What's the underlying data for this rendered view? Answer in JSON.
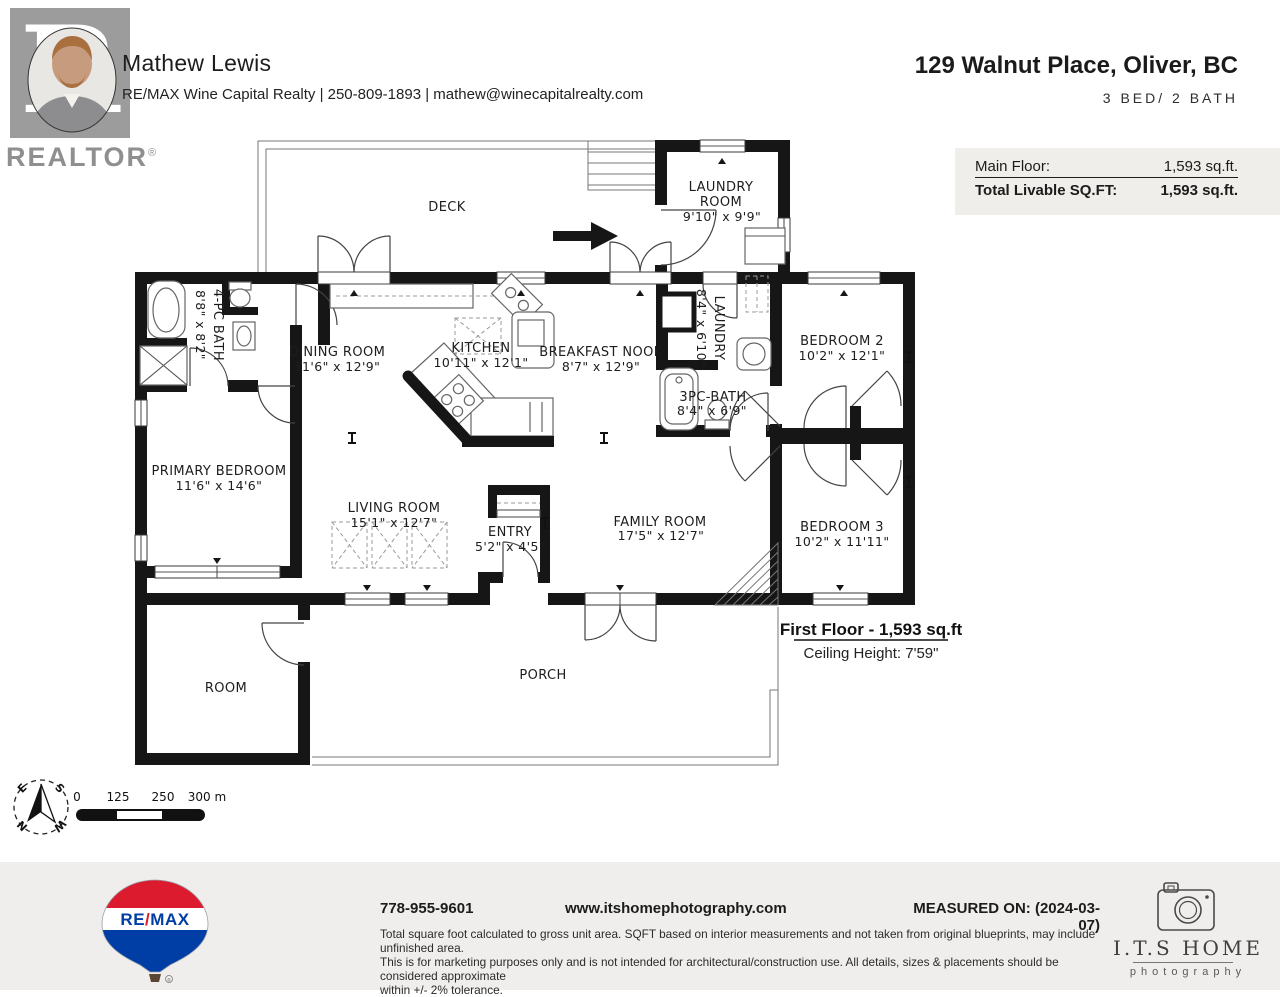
{
  "header": {
    "agent_name": "Mathew Lewis",
    "agent_line": "RE/MAX Wine Capital Realty | 250-809-1893 | mathew@winecapitalrealty.com",
    "realtor_word": "REALTOR",
    "reg": "®",
    "address": "129 Walnut Place, Oliver, BC",
    "bed_bath": "3 BED/ 2 BATH"
  },
  "sqft_box": {
    "rows": [
      {
        "label": "Main Floor:",
        "value": "1,593 sq.ft."
      },
      {
        "label": "Total Livable SQ.FT:",
        "value": "1,593 sq.ft."
      }
    ]
  },
  "plan": {
    "rooms": {
      "deck": {
        "name": "DECK"
      },
      "laundry_room": {
        "l1": "LAUNDRY",
        "l2": "ROOM",
        "dims": "9'10\" x 9'9\""
      },
      "bath4": {
        "name": "4-PC BATH",
        "dims": "8'8\" x 8'2\""
      },
      "dining": {
        "name": "DINING ROOM",
        "dims": "11'6\" x 12'9\""
      },
      "kitchen": {
        "name": "KITCHEN",
        "dims": "10'11\" x 12'1\""
      },
      "nook": {
        "name": "BREAKFAST NOOK",
        "dims": "8'7\" x 12'9\""
      },
      "laundry2": {
        "name": "LAUNDRY",
        "dims": "8'4\" x 6'10\""
      },
      "bed2": {
        "name": "BEDROOM 2",
        "dims": "10'2\" x 12'1\""
      },
      "bath3": {
        "name": "3PC-BATH",
        "dims": "8'4\" x 6'9\""
      },
      "primary": {
        "name": "PRIMARY BEDROOM",
        "dims": "11'6\" x 14'6\""
      },
      "living": {
        "name": "LIVING ROOM",
        "dims": "15'1\" x 12'7\""
      },
      "entry": {
        "name": "ENTRY",
        "dims": "5'2\" x 4'5\""
      },
      "family": {
        "name": "FAMILY ROOM",
        "dims": "17'5\" x 12'7\""
      },
      "bed3": {
        "name": "BEDROOM 3",
        "dims": "10'2\" x 11'11\""
      },
      "room": {
        "name": "ROOM"
      },
      "porch": {
        "name": "PORCH"
      }
    },
    "floor_note": {
      "title": "First Floor - 1,593 sq.ft",
      "ceiling": "Ceiling Height: 7'59\""
    }
  },
  "compass": {
    "e": "E",
    "s": "S",
    "n": "N",
    "w": "W"
  },
  "scale_bar": {
    "t0": "0",
    "t1": "125",
    "t2": "250",
    "t3": "300 m"
  },
  "footer": {
    "phone": "778-955-9601",
    "website": "www.itshomephotography.com",
    "measured_on": "MEASURED ON: (2024-03-07)",
    "disclaimer_1": "Total square foot calculated to gross unit area. SQFT based on interior measurements and not taken from original blueprints, may include unfinished area.",
    "disclaimer_2": "This is for marketing purposes only and is not intended for architectural/construction use. All details, sizes & placements should be considered approximate",
    "disclaimer_3": "within +/- 2% tolerance.",
    "remax": {
      "re": "RE",
      "slash": "/",
      "max": "MAX"
    },
    "its": {
      "title": "I.T.S HOME",
      "subtitle": "photography"
    }
  }
}
